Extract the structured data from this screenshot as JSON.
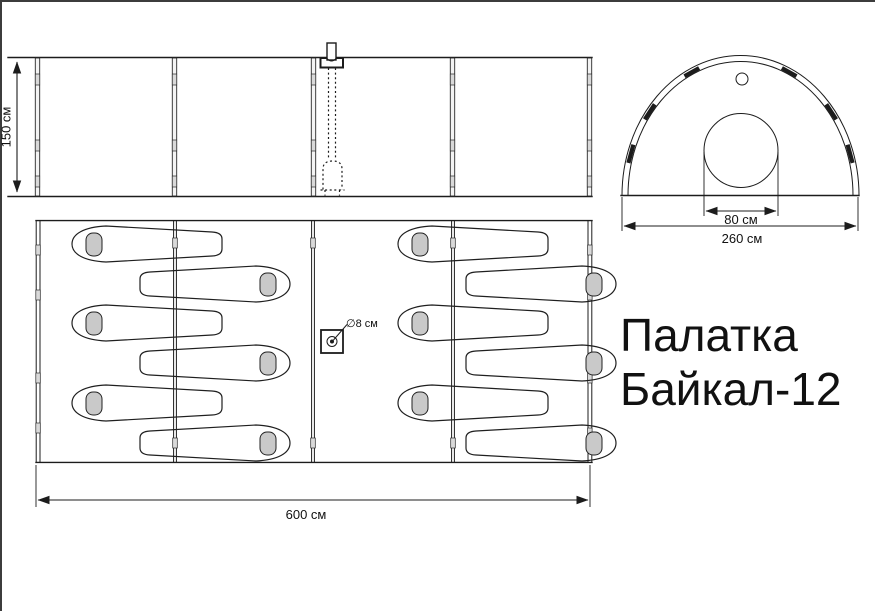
{
  "page": {
    "background": "#ffffff",
    "edge_color": "#3c3c3c"
  },
  "title": {
    "line1": "Палатка",
    "line2": "Байкал-12"
  },
  "views": {
    "side_elevation": {
      "height_dim_label": "150 см",
      "panel_count": 4
    },
    "front_arch": {
      "entrance_dim_label": "80 см",
      "width_dim_label": "260 см"
    },
    "floor_plan": {
      "length_dim_label": "600 см",
      "stove_pipe_label": "∅8 см",
      "sleeping_bag_count": 12
    }
  },
  "colors": {
    "line": "#1c1c1c",
    "pillow_fill": "#c9c9c9",
    "joint_fill": "#d9d9d9",
    "edge": "#3c3c3c"
  }
}
